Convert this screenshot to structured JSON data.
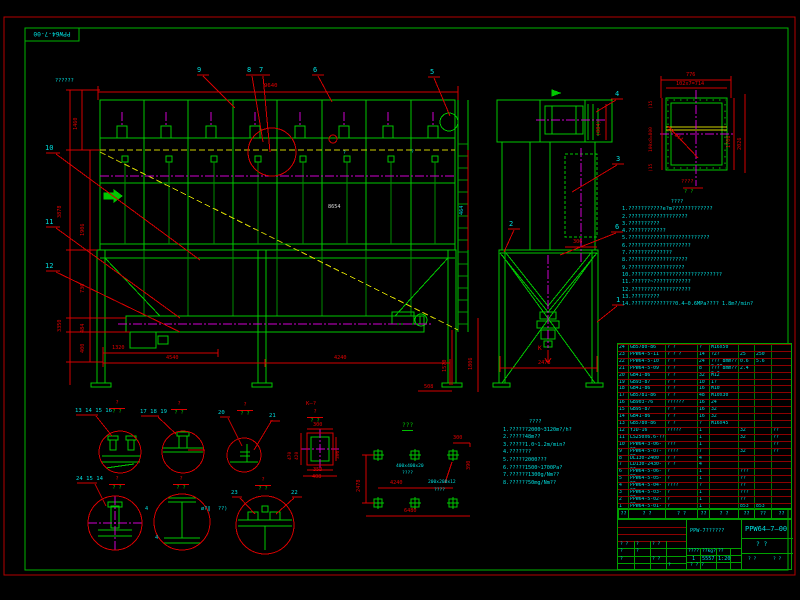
{
  "corner": "PPW64-7-00",
  "mv": {
    "lbl": "??????",
    "d9640": "9640",
    "d1460": "1460",
    "d3878": "3878",
    "d3350": "3350",
    "d1906": "1906",
    "d730": "730",
    "d484": "484",
    "d400": "400",
    "d1320": "1320",
    "d4540": "4540",
    "d4240": "4240",
    "d1570": "1570",
    "d1806": "1806",
    "d508": "508",
    "d8654": "8654",
    "d464": "464",
    "b5": "5",
    "b6": "6",
    "b7": "7",
    "b8": "8",
    "b9": "9",
    "b10": "10",
    "b11": "11",
    "b12": "12",
    "m1": "?",
    "m2": "?"
  },
  "sv": {
    "d884": "(884)",
    "d306": "306",
    "d2478": "2478",
    "k": "K",
    "b1": "1",
    "b2": "2",
    "b3": "3",
    "b4": "4",
    "b6": "6"
  },
  "fd": {
    "d776": "776",
    "drow": "102x7=714",
    "dcol": "100x8=800",
    "e1": "(15",
    "e2": "(15",
    "r1": "1706",
    "r2": "2026",
    "holes": "28-ø14",
    "capn": "????",
    "capd": "?  ?"
  },
  "nr": {
    "head": "????",
    "lines": [
      "1.???????????e?m?????????????",
      "2.???????????????????",
      "3.??????????",
      "4.????????????",
      "5.??????????????????????????",
      "6.????????????????????",
      "7.??????????????",
      "8.???????????????????",
      "9.??????????????????",
      "10.?????????????????????????????",
      "11.??????~????????????",
      "12.???????????????????",
      "13.?????????",
      "14.??????????????0.4—0.6MPa???? 1.8m?/min?"
    ]
  },
  "nb": {
    "head": "????",
    "lines": [
      "1.??????2000~3120m?/h?",
      "2.?????48m??",
      "3.?????1.0~1.2m/min?",
      "4.???????",
      "5.?????2000???",
      "6.?????1500~1700Pa?",
      "7.??????1300g/Nm??",
      "8.??????50mg/Nm??"
    ]
  },
  "fp": {
    "title": "???",
    "d2478": "2478",
    "d4240": "4240",
    "d6480": "6480",
    "d300": "300",
    "d390": "390",
    "p1": "400x400x20",
    "p1b": "????",
    "p2": "200x200x12",
    "p2b": "????"
  },
  "ks": {
    "k": "K—?",
    "t": "300",
    "l1": "470",
    "l2": "420",
    "r": "306",
    "b1": "350",
    "b2": "408"
  },
  "dt": {
    "g1": "13 14 15 16",
    "g2": "17 18 19",
    "g3": "20",
    "g3b": "21",
    "g4": "24 15 14",
    "g5": "23",
    "g5b": "22",
    "fn": "?",
    "fdn": "?  ?",
    "w4": "4",
    "wl": "ø?‖",
    "wr": "??)",
    "w4b": "4"
  },
  "pt": {
    "headers": [
      "??",
      "? ?",
      "? ?",
      "??",
      "? ?",
      "??",
      "??",
      "??"
    ],
    "rows": [
      [
        "24",
        "GB5780-86",
        "? ?",
        "?",
        "M16x50",
        "",
        "",
        ""
      ],
      [
        "23",
        "PPW64-5-11",
        "? ? ?",
        "14",
        "?2?",
        "25",
        "250",
        ""
      ],
      [
        "22",
        "PPW64-5-10",
        "? ?",
        "24",
        "??? 8mm??0.38",
        "0.6",
        "5.6",
        ""
      ],
      [
        "21",
        "PPW64-5-09",
        "? ?",
        "8",
        "??? 8mm??0.3",
        "2.4",
        "",
        ""
      ],
      [
        "20",
        "GB41-86",
        "? ?",
        "32",
        "M12",
        "",
        "",
        ""
      ],
      [
        "19",
        "GB93-87",
        "? ?",
        "10",
        "1?",
        "",
        "",
        ""
      ],
      [
        "18",
        "GB41-86",
        "? ?",
        "16",
        "M10",
        "",
        "",
        ""
      ],
      [
        "17",
        "GB5781-86",
        "? ?",
        "48",
        "M10x30",
        "",
        "",
        ""
      ],
      [
        "16",
        "GB903-76",
        "??????",
        "16",
        "24",
        "",
        "",
        ""
      ],
      [
        "15",
        "GB95-87",
        "? ?",
        "16",
        "32",
        "",
        "",
        ""
      ],
      [
        "14",
        "GB41-86",
        "? ?",
        "16",
        "32",
        "",
        "",
        ""
      ],
      [
        "13",
        "GB5780-86",
        "? ?",
        "?",
        "M16x45",
        "",
        "",
        ""
      ],
      [
        "12",
        "YJD-16",
        "?????",
        "1",
        "",
        "32",
        "",
        "??"
      ],
      [
        "11",
        "LS250x6.6-??????",
        "",
        "1",
        "",
        "32",
        "",
        "??"
      ],
      [
        "10",
        "PPW64-3-06-00",
        "???",
        "1",
        "",
        "",
        "",
        "??"
      ],
      [
        "9",
        "PPW64-5-07-00",
        "????",
        "7",
        "",
        "32",
        "",
        "??"
      ],
      [
        "8",
        "DL130-2400",
        "? ?",
        "4",
        "",
        "",
        "",
        ""
      ],
      [
        "7",
        "LD130-2430-0?",
        "? ?",
        "4",
        "",
        "",
        "",
        ""
      ],
      [
        "6",
        "PPW64-5-06-00",
        "?",
        "1",
        "",
        "???",
        "",
        ""
      ],
      [
        "5",
        "PPW64-5-05-00",
        "?",
        "1",
        "",
        "??",
        "",
        ""
      ],
      [
        "4",
        "PPW64-5-04-00",
        "????",
        "?",
        "",
        "??",
        "",
        ""
      ],
      [
        "3",
        "PPW64-5-03-00",
        "?",
        "1",
        "",
        "???",
        "",
        ""
      ],
      [
        "2",
        "PPW64-5-02-00",
        "?",
        "1",
        "",
        "??",
        "",
        ""
      ],
      [
        "1",
        "PPW64-5-01-00",
        "?",
        "1",
        "",
        "853",
        "853",
        ""
      ]
    ]
  },
  "tb": {
    "no": "PPW64—7—00",
    "name": "PPW-7??????",
    "sub": "?   ?",
    "mh1": "????",
    "mh2": "??kg?",
    "mh3": "??",
    "mv1": "1",
    "mv2": "5557",
    "mv3": "1:20",
    "mf": "?   ?   ?",
    "q": "?",
    "qq": "? ?"
  }
}
